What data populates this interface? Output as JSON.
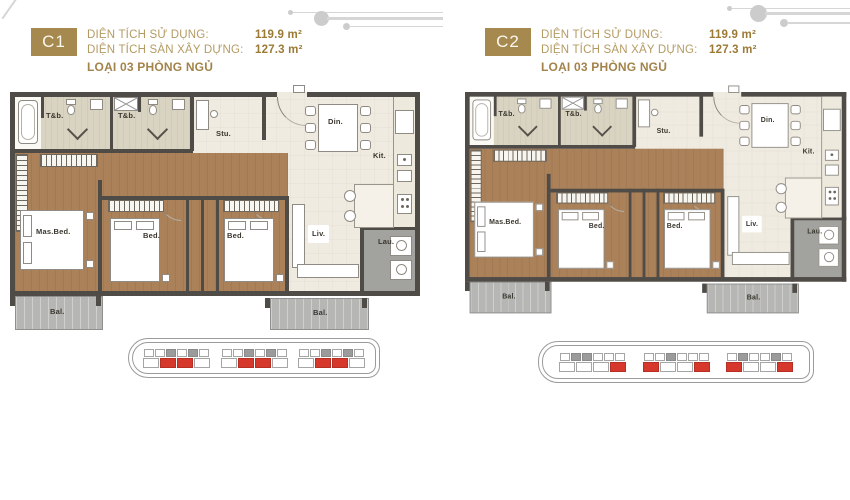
{
  "room_labels": {
    "bath": "T&b.",
    "study": "Stu.",
    "dining": "Din.",
    "kitchen": "Kit.",
    "master": "Mas.Bed.",
    "bedroom": "Bed.",
    "living": "Liv.",
    "laundry": "Lau.",
    "balcony": "Bal."
  },
  "units": [
    {
      "code": "C1",
      "stats": [
        {
          "label": "DIỆN TÍCH SỬ DỤNG:",
          "value": "119.9 m²"
        },
        {
          "label": "DIỆN TÍCH SÀN XÂY DỰNG:",
          "value": "127.3 m²"
        }
      ],
      "type_line": "LOẠI 03 PHÒNG NGỦ",
      "locator": {
        "groups": [
          {
            "top": [
              "w",
              "w",
              "g",
              "w",
              "g",
              "w"
            ],
            "bottom": [
              "w",
              "r",
              "r",
              "w"
            ]
          },
          {
            "top": [
              "w",
              "w",
              "g",
              "w",
              "g",
              "w"
            ],
            "bottom": [
              "w",
              "r",
              "r",
              "w"
            ]
          },
          {
            "top": [
              "w",
              "w",
              "g",
              "w",
              "g",
              "w"
            ],
            "bottom": [
              "w",
              "r",
              "r",
              "w"
            ]
          }
        ]
      }
    },
    {
      "code": "C2",
      "stats": [
        {
          "label": "DIỆN TÍCH SỬ DỤNG:",
          "value": "119.9 m²"
        },
        {
          "label": "DIỆN TÍCH SÀN XÂY DỰNG:",
          "value": "127.3 m²"
        }
      ],
      "type_line": "LOẠI 03 PHÒNG NGỦ",
      "locator": {
        "groups": [
          {
            "top": [
              "w",
              "g",
              "g",
              "w",
              "w",
              "w"
            ],
            "bottom": [
              "w",
              "w",
              "w",
              "r"
            ]
          },
          {
            "top": [
              "w",
              "w",
              "g",
              "w",
              "w",
              "w"
            ],
            "bottom": [
              "r",
              "w",
              "w",
              "r"
            ]
          },
          {
            "top": [
              "w",
              "g",
              "w",
              "w",
              "g",
              "w"
            ],
            "bottom": [
              "r",
              "w",
              "w",
              "r"
            ]
          }
        ]
      }
    }
  ],
  "colors": {
    "badge_gold": "#a6894e",
    "label_gold": "#b49b64",
    "value_gold": "#9b7a35",
    "wall": "#4f4b47",
    "wood_floor": "#ab8159",
    "cream_floor": "#f0ebe0",
    "bath_tile": "#d8d4c1",
    "balcony_gray": "#b6b6b4",
    "laundry_gray": "#a2a29e",
    "locator_red": "#d6382c",
    "locator_gray": "#9b9b9b"
  }
}
